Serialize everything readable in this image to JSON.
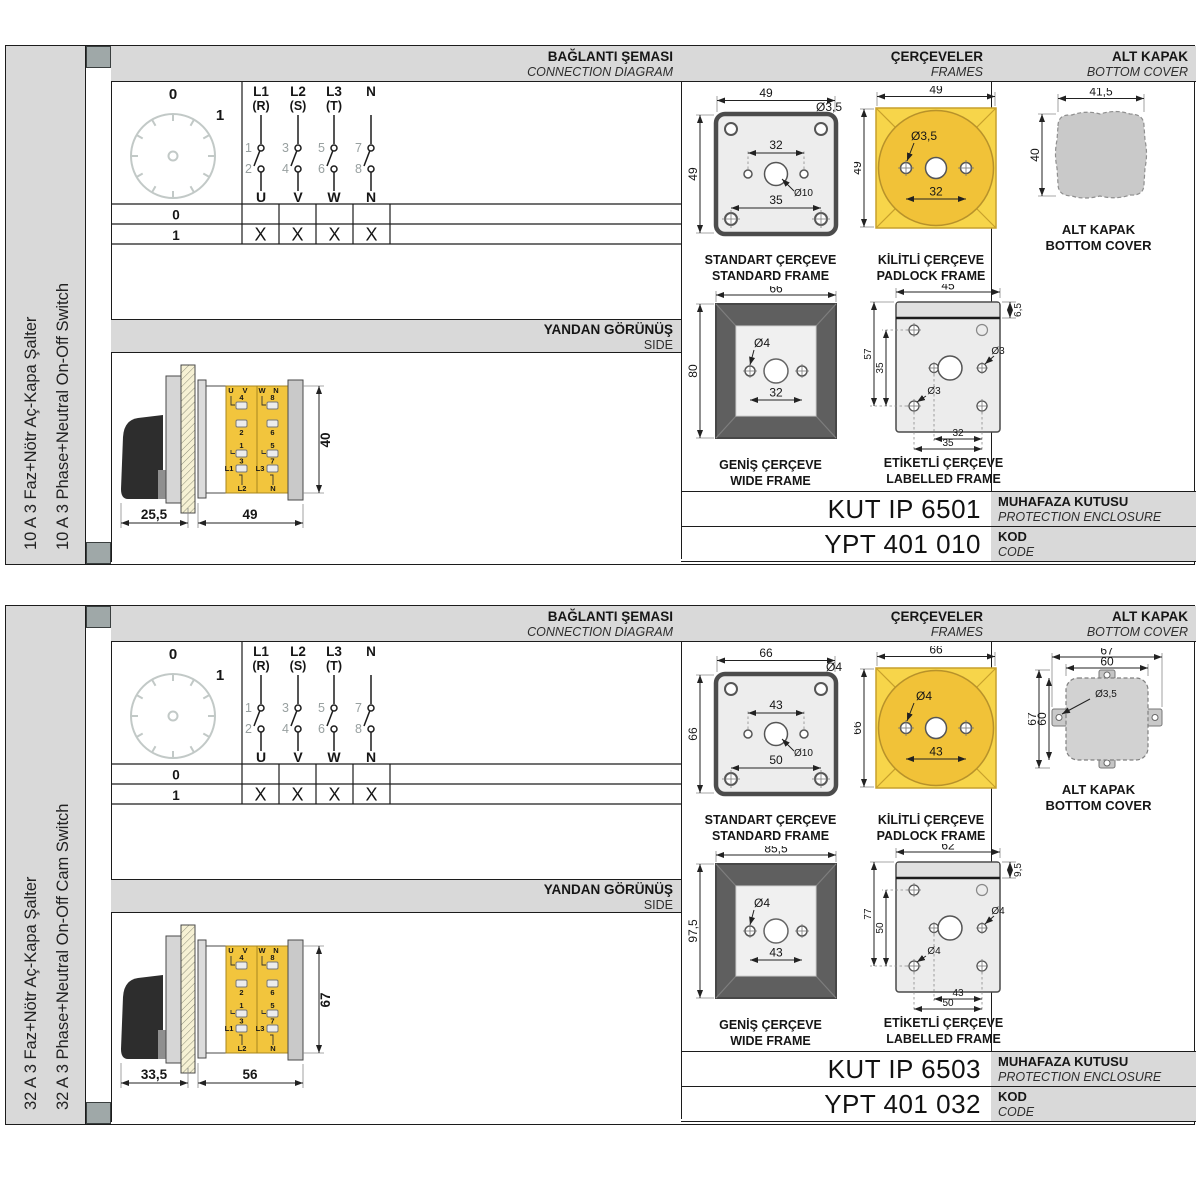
{
  "common": {
    "header": {
      "connection_tr": "BAĞLANTI ŞEMASI",
      "connection_en": "CONNECTION DIAGRAM",
      "frames_tr": "ÇERÇEVELER",
      "frames_en": "FRAMES",
      "cover_tr": "ALT KAPAK",
      "cover_en": "BOTTOM COVER"
    },
    "side_header": {
      "tr": "YANDAN GÖRÜNÜŞ",
      "en": "SIDE"
    },
    "diagram": {
      "positions": {
        "off": "0",
        "on": "1"
      },
      "phases": [
        {
          "label": "L1",
          "sub": "(R)",
          "in": "1",
          "out": "2",
          "terminal": "U"
        },
        {
          "label": "L2",
          "sub": "(S)",
          "in": "3",
          "out": "4",
          "terminal": "V"
        },
        {
          "label": "L3",
          "sub": "(T)",
          "in": "5",
          "out": "6",
          "terminal": "W"
        },
        {
          "label": "N",
          "sub": "",
          "in": "7",
          "out": "8",
          "terminal": "N"
        }
      ],
      "table": {
        "row0": {
          "pos": "0",
          "marks": [
            "",
            "",
            "",
            ""
          ]
        },
        "row1": {
          "pos": "1",
          "marks": [
            "X",
            "X",
            "X",
            "X"
          ]
        }
      }
    },
    "captions": {
      "standard_tr": "STANDART ÇERÇEVE",
      "standard_en": "STANDARD FRAME",
      "padlock_tr": "KİLİTLİ ÇERÇEVE",
      "padlock_en": "PADLOCK FRAME",
      "wide_tr": "GENİŞ ÇERÇEVE",
      "wide_en": "WIDE FRAME",
      "labelled_tr": "ETİKETLİ ÇERÇEVE",
      "labelled_en": "LABELLED FRAME",
      "cover_tr": "ALT KAPAK",
      "cover_en": "BOTTOM COVER"
    },
    "enclosure_label": {
      "tr": "MUHAFAZA KUTUSU",
      "en": "PROTECTION ENCLOSURE"
    },
    "code_label": {
      "tr": "KOD",
      "en": "CODE"
    },
    "side_terminals": {
      "u": "U",
      "v": "V",
      "w": "W",
      "n": "N",
      "t4": "4",
      "t2": "2",
      "t1": "1",
      "t3": "3",
      "t8": "8",
      "t6": "6",
      "t5": "5",
      "t7": "7",
      "l1": "L1",
      "l2": "L2",
      "l3": "L3",
      "nn": "N"
    }
  },
  "sections": [
    {
      "title_tr": "10 A 3 Faz+Nötr Aç-Kapa Şalter",
      "title_en": "10 A 3 Phase+Neutral On-Off Switch",
      "standard_frame": {
        "width": "49",
        "height": "49",
        "corner_hole": "Ø3,5",
        "hole_spacing": "32",
        "center_hole": "Ø10",
        "bottom_spacing": "35"
      },
      "padlock_frame": {
        "width": "49",
        "height": "49",
        "hole": "Ø3,5",
        "hole_spacing": "32"
      },
      "bottom_cover": {
        "width": "41,5",
        "height": "40"
      },
      "wide_frame": {
        "width": "66",
        "height": "80",
        "hole": "Ø4",
        "hole_spacing": "32"
      },
      "labelled_frame": {
        "width": "45",
        "strip": "6,5",
        "height": "57",
        "v_spacing": "35",
        "hole_right": "Ø3",
        "hole_left": "Ø3",
        "bottom_inner": "32",
        "bottom_outer": "35"
      },
      "side_view": {
        "handle_depth": "25,5",
        "body_width": "49",
        "body_height": "40"
      },
      "enclosure_code": "KUT IP 6501",
      "order_code": "YPT 401 010"
    },
    {
      "title_tr": "32 A 3 Faz+Nötr Aç-Kapa Şalter",
      "title_en": "32 A 3 Phase+Neutral On-Off Cam Switch",
      "standard_frame": {
        "width": "66",
        "height": "66",
        "corner_hole": "Ø4",
        "hole_spacing": "43",
        "center_hole": "Ø10",
        "bottom_spacing": "50"
      },
      "padlock_frame": {
        "width": "66",
        "height": "66",
        "hole": "Ø4",
        "hole_spacing": "43"
      },
      "bottom_cover": {
        "width": "67",
        "width_inner": "60",
        "height": "67",
        "height_inner": "60",
        "hole": "Ø3,5"
      },
      "wide_frame": {
        "width": "85,5",
        "height": "97,5",
        "hole": "Ø4",
        "hole_spacing": "43"
      },
      "labelled_frame": {
        "width": "62",
        "strip": "9,5",
        "height": "77",
        "v_spacing": "50",
        "hole_right": "Ø4",
        "hole_left": "Ø4",
        "bottom_inner": "43",
        "bottom_outer": "50"
      },
      "side_view": {
        "handle_depth": "33,5",
        "body_width": "56",
        "body_height": "67"
      },
      "enclosure_code": "KUT IP 6503",
      "order_code": "YPT 401 032"
    }
  ],
  "colors": {
    "accent_yellow": "#f5c63f",
    "frame_dark": "#5e5e5e",
    "header_gray": "#d9d9d9",
    "line": "#1c1c1c"
  }
}
